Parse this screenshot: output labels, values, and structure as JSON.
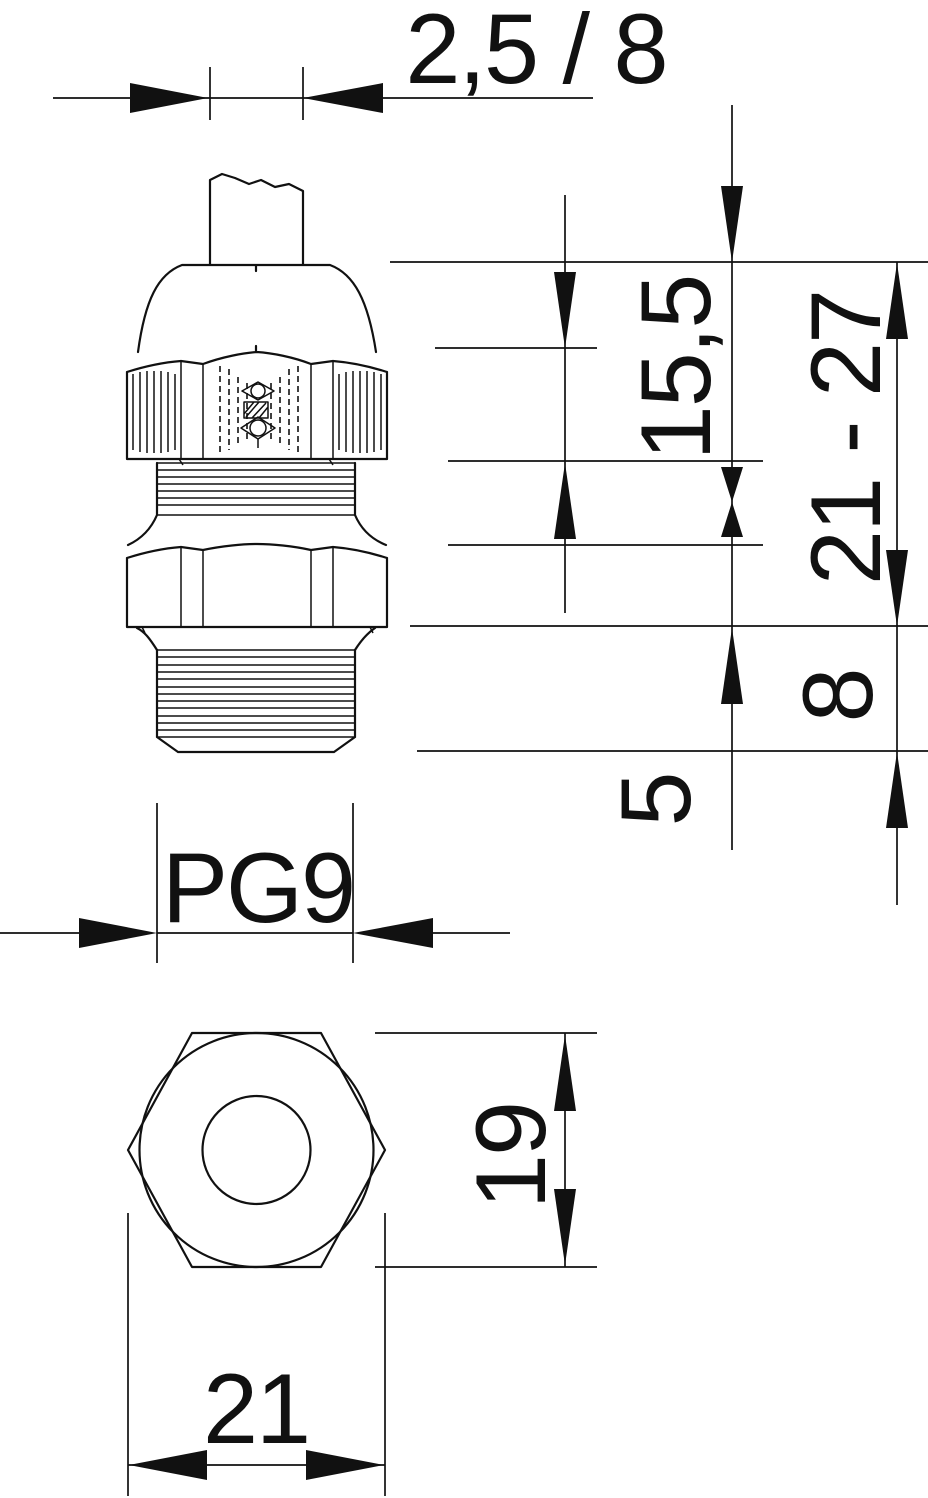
{
  "drawing": {
    "labels": {
      "clamping_range": "2,5 / 8",
      "upper_height": "15,5",
      "overall_height_range": "21 - 27",
      "thread_length": "8",
      "thread_protrusion": "5",
      "thread_size": "PG9",
      "across_flats": "19",
      "across_corners": "21"
    },
    "colors": {
      "line": "#111111",
      "background": "#ffffff"
    }
  }
}
